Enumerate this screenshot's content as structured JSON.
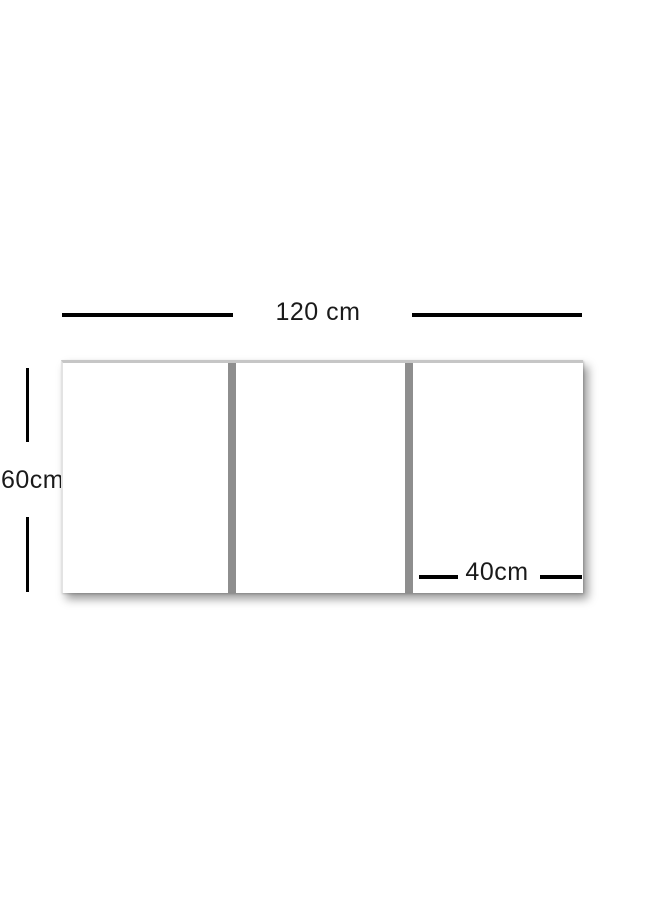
{
  "diagram": {
    "type": "triptych-panel-size-diagram",
    "total_width": {
      "label": "120 cm"
    },
    "total_height": {
      "label": "60cm"
    },
    "panel_width": {
      "label": "40cm"
    },
    "panels": {
      "count": 3
    },
    "colors": {
      "background": "#ffffff",
      "panel_face": "#ffffff",
      "panel_gap": "#8e8e8e",
      "panel_edge_top": "#c6c6c6",
      "panel_edge_left": "#e3e3e3",
      "dimension_line": "#000000",
      "label_text": "#1a1a1a",
      "shadow": "rgba(0,0,0,0.40)"
    }
  }
}
